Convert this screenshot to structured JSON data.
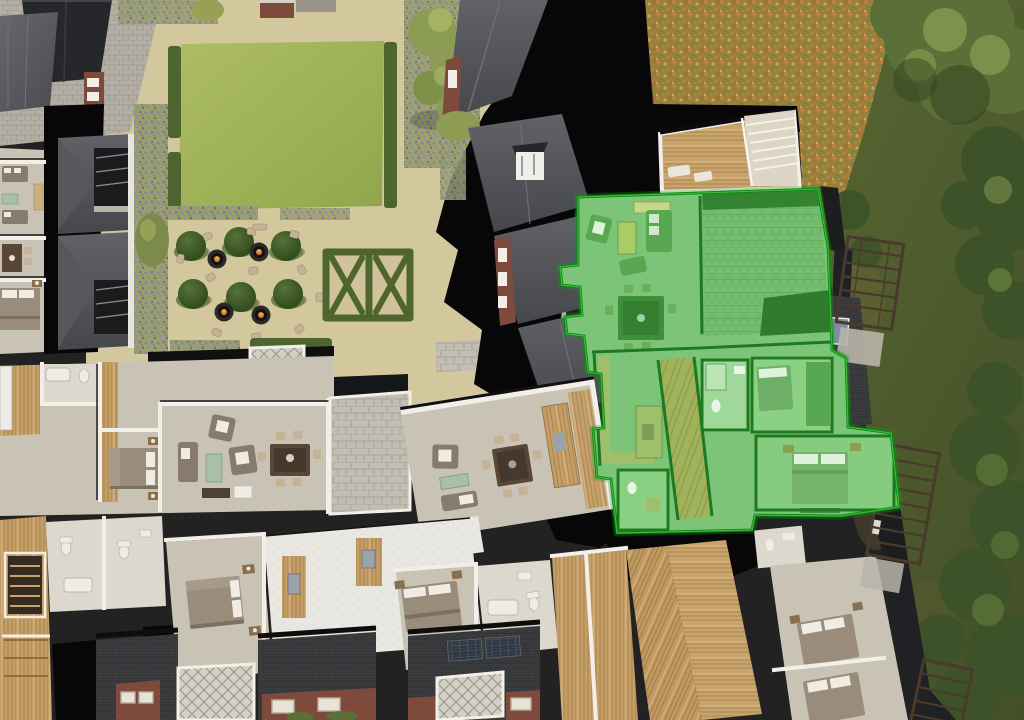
{
  "scene": {
    "title": "3d-aerial-development-siteplan",
    "description": "Photoreal aerial cutaway render of an apartment development: furnished floor plans, communal garden with topiary and fire-pit seating, double-X hedge parterre, wildflower meadow and mature trees on the right, one apartment highlighted in green.",
    "highlighted_unit": {
      "name": "selected-apartment",
      "state": "highlighted",
      "highlight_fill": "#7cc477",
      "outline_color": "#0c8712",
      "rooms": [
        "living-room",
        "dining-area",
        "kitchen",
        "hallway",
        "bathroom",
        "bedroom",
        "master-bedroom",
        "roof-terrace"
      ]
    },
    "garden": {
      "lawn_panels": 1,
      "topiary_balls": 6,
      "fire_pit_tables": 4,
      "seating_chairs": 10,
      "parterre_style": "double-X hedge"
    },
    "environment": {
      "meadow": "orange-yellow wildflowers",
      "right_edge": "mature trees and dark grass",
      "pergolas": 3
    },
    "buildings": {
      "style": "cutaway furnished floor plans",
      "roofs": [
        "charcoal",
        "slate gray"
      ],
      "facades": "red brick with stone window surrounds",
      "solar_arrays": 3
    }
  },
  "palette": {
    "gravel": "#d3c79e",
    "paving": "#b3afa5",
    "lawn": "#a3b55b",
    "hedge": "#4e6530",
    "lavender": "#8b83a9",
    "topiary": "#3a5426",
    "meadow": "#97803f",
    "grass": "#55602f",
    "tree_dark": "#3e5229",
    "tree_mid": "#5a7038",
    "tree_light": "#83994f",
    "black": "#070708",
    "roof_dark": "#26272a",
    "roof_slate": "#3c3d40",
    "roof_gray": "#5a5c60",
    "wall": "#f2efe8",
    "floor": "#c9c3b6",
    "concrete": "#e9e7e1",
    "wood": "#c49e66",
    "wood_light": "#d4b07c",
    "brick": "#7e4a3c",
    "stone": "#b9b4a9",
    "solar": "#2e3742",
    "sofa": "#867b6d",
    "pillow": "#f0ece3",
    "table_dark": "#5a4636",
    "chair_tan": "#c6b294",
    "table_green": "#a9c0a8",
    "bed": "#998c7b",
    "fire": "#e0812f",
    "trellis": "#4a3a2c",
    "green_fill": "#7cc477",
    "green_mid": "#58a851",
    "green_dark": "#2e7c2a",
    "green_wall": "#1f7a1f",
    "green_outline": "#0c8712",
    "green_terr": "#74bd6e"
  }
}
